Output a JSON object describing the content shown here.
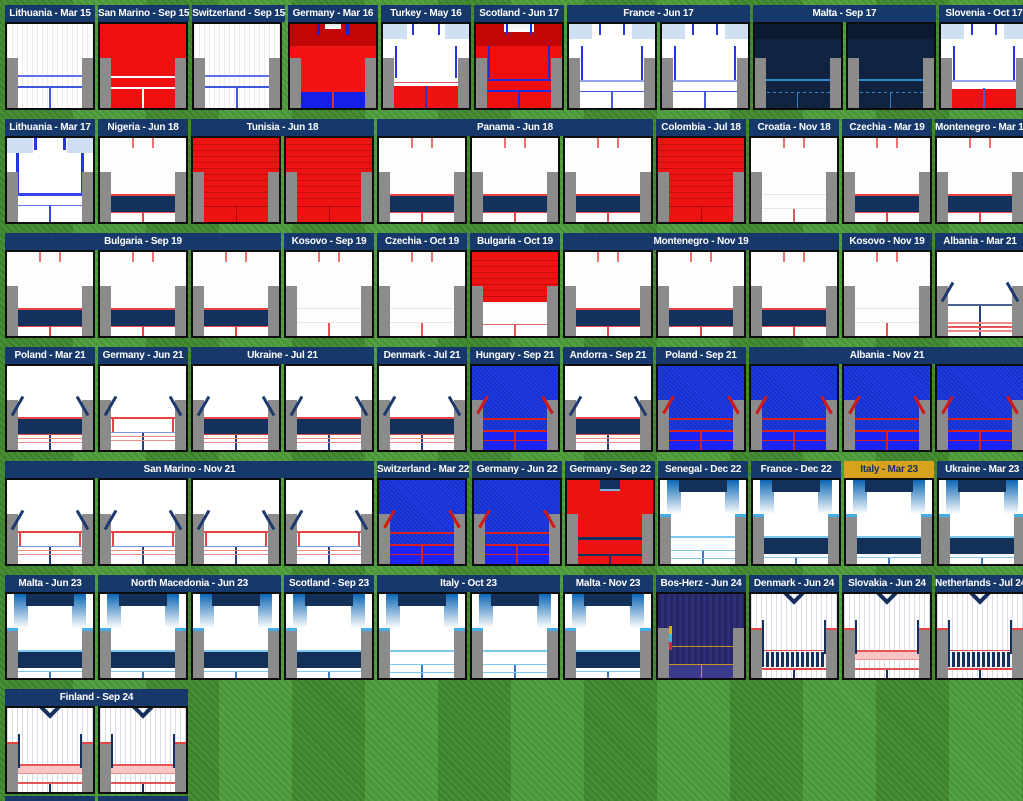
{
  "palette": {
    "header_navy": "#17386a",
    "header_gold": "#d7a31d",
    "grass_dark": "#41892f",
    "grass_light": "#4f9e3d",
    "jersey_border": "#0d0d0d",
    "sleeve_gray": "#8b8b8b"
  },
  "rows": [
    {
      "cells": [
        {
          "label": "Lithuania - Mar 15",
          "kit": "pinstripe15",
          "count": 1
        },
        {
          "label": "San Marino - Sep 15",
          "kit": "red15",
          "count": 1
        },
        {
          "label": "Switzerland - Sep 15",
          "kit": "pinstripe15",
          "count": 1
        },
        {
          "label": "Germany - Mar 16",
          "kit": "germany16",
          "count": 1
        },
        {
          "label": "Turkey - May 16",
          "kit": "turkey16",
          "count": 1
        },
        {
          "label": "Scotland - Jun 17",
          "kit": "scotland17",
          "count": 1
        },
        {
          "label": "France - Jun 17",
          "kit": "white17",
          "count": 2
        },
        {
          "label": "Malta - Sep 17",
          "kit": "navy17",
          "count": 2
        },
        {
          "label": "Slovenia - Oct 17",
          "kit": "slovenia17",
          "count": 1
        }
      ]
    },
    {
      "cells": [
        {
          "label": "Lithuania - Mar 17",
          "kit": "lithuania17",
          "count": 1
        },
        {
          "label": "Nigeria - Jun 18",
          "kit": "navyband18",
          "count": 1
        },
        {
          "label": "Tunisia - Jun 18",
          "kit": "redtex18",
          "count": 2
        },
        {
          "label": "Panama - Jun 18",
          "kit": "navyband18",
          "count": 3
        },
        {
          "label": "Colombia - Jul 18",
          "kit": "redtex18",
          "count": 1
        },
        {
          "label": "Croatia - Nov 18",
          "kit": "whiteplain",
          "count": 1
        },
        {
          "label": "Czechia - Mar 19",
          "kit": "navyband18",
          "count": 1
        },
        {
          "label": "Montenegro - Mar 19",
          "kit": "navyband18",
          "count": 1
        }
      ]
    },
    {
      "cells": [
        {
          "label": "Bulgaria - Sep 19",
          "kit": "navyband18",
          "count": 3
        },
        {
          "label": "Kosovo - Sep 19",
          "kit": "whiteplain",
          "count": 1
        },
        {
          "label": "Czechia - Oct 19",
          "kit": "whiteplain",
          "count": 1
        },
        {
          "label": "Bulgaria - Oct 19",
          "kit": "bulgaria19",
          "count": 1
        },
        {
          "label": "Montenegro - Nov 19",
          "kit": "navyband18",
          "count": 3
        },
        {
          "label": "Kosovo - Nov 19",
          "kit": "whiteplain",
          "count": 1
        },
        {
          "label": "Albania - Mar 21",
          "kit": "albania21",
          "count": 1
        }
      ]
    },
    {
      "cells": [
        {
          "label": "Poland - Mar 21",
          "kit": "diagband21",
          "count": 1
        },
        {
          "label": "Germany - Jun 21",
          "kit": "diagwhite21",
          "count": 1
        },
        {
          "label": "Ukraine - Jul 21",
          "kit": "diagband21",
          "count": 2
        },
        {
          "label": "Denmark - Jul 21",
          "kit": "diagband21",
          "count": 1
        },
        {
          "label": "Hungary - Sep 21",
          "kit": "blue21",
          "count": 1
        },
        {
          "label": "Andorra - Sep 21",
          "kit": "diagband21",
          "count": 1
        },
        {
          "label": "Poland - Sep 21",
          "kit": "blue21",
          "count": 1
        },
        {
          "label": "Albania - Nov 21",
          "kit": "blue21",
          "count": 3
        }
      ]
    },
    {
      "cells": [
        {
          "label": "San Marino - Nov 21",
          "kit": "diagwhite21",
          "count": 4
        },
        {
          "label": "Switzerland - Mar 22",
          "kit": "blue21",
          "count": 1
        },
        {
          "label": "Germany - Jun 22",
          "kit": "blue21",
          "count": 1
        },
        {
          "label": "Germany - Sep 22",
          "kit": "germany22",
          "count": 1
        },
        {
          "label": "Senegal - Dec 22",
          "kit": "gradient22",
          "count": 1
        },
        {
          "label": "France - Dec 22",
          "kit": "gradientband22",
          "count": 1
        },
        {
          "label": "Italy - Mar 23",
          "kit": "gradientband22",
          "count": 1,
          "header": "gold"
        },
        {
          "label": "Ukraine - Mar 23",
          "kit": "gradientband22",
          "count": 1
        }
      ]
    },
    {
      "cells": [
        {
          "label": "Malta - Jun 23",
          "kit": "gradientband22",
          "count": 1
        },
        {
          "label": "North Macedonia - Jun 23",
          "kit": "gradientband22",
          "count": 2
        },
        {
          "label": "Scotland - Sep 23",
          "kit": "gradientband22",
          "count": 1
        },
        {
          "label": "Italy - Oct 23",
          "kit": "gradient22",
          "count": 2
        },
        {
          "label": "Malta - Nov 23",
          "kit": "gradientband22",
          "count": 1
        },
        {
          "label": "Bos-Herz - Jun 24",
          "kit": "bosherz24",
          "count": 1
        },
        {
          "label": "Denmark - Jun 24",
          "kit": "pinstripe24navy",
          "count": 1
        },
        {
          "label": "Slovakia - Jun 24",
          "kit": "pinstripe24red",
          "count": 1
        },
        {
          "label": "Netherlands - Jul 24",
          "kit": "pinstripe24navy",
          "count": 1
        }
      ]
    },
    {
      "cells": [
        {
          "label": "Finland - Sep 24",
          "kit": "pinstripe24red",
          "count": 2
        }
      ]
    }
  ],
  "chart_data": {
    "type": "table",
    "title": "Shirts worn by match (opponent - date)",
    "columns": [
      "Match",
      "Kit style",
      "Shirts shown",
      "Header colour"
    ],
    "rows": [
      [
        "Lithuania - Mar 15",
        "white pinstripe, blue trim",
        1,
        "navy"
      ],
      [
        "San Marino - Sep 15",
        "red, white trim",
        1,
        "navy"
      ],
      [
        "Switzerland - Sep 15",
        "white pinstripe, blue trim",
        1,
        "navy"
      ],
      [
        "Germany - Mar 16",
        "red with blue hem",
        1,
        "navy"
      ],
      [
        "Turkey - May 16",
        "white with red hem",
        1,
        "navy"
      ],
      [
        "Scotland - Jun 17",
        "red with blue trim",
        1,
        "navy"
      ],
      [
        "France - Jun 17",
        "white, blue trim",
        2,
        "navy"
      ],
      [
        "Malta - Sep 17",
        "dark navy",
        2,
        "navy"
      ],
      [
        "Slovenia - Oct 17",
        "white with red hem",
        1,
        "navy"
      ],
      [
        "Lithuania - Mar 17",
        "white, bold blue lines",
        1,
        "navy"
      ],
      [
        "Nigeria - Jun 18",
        "white, navy band, red trim",
        1,
        "navy"
      ],
      [
        "Tunisia - Jun 18",
        "red textured",
        2,
        "navy"
      ],
      [
        "Panama - Jun 18",
        "white, navy band, red trim",
        3,
        "navy"
      ],
      [
        "Colombia - Jul 18",
        "red textured",
        1,
        "navy"
      ],
      [
        "Croatia - Nov 18",
        "plain white, red collar ticks",
        1,
        "navy"
      ],
      [
        "Czechia - Mar 19",
        "white, navy band, red trim",
        1,
        "navy"
      ],
      [
        "Montenegro - Mar 19",
        "white, navy band, red trim",
        1,
        "navy"
      ],
      [
        "Bulgaria - Sep 19",
        "white, navy band, red trim",
        3,
        "navy"
      ],
      [
        "Kosovo - Sep 19",
        "plain white, red collar ticks",
        1,
        "navy"
      ],
      [
        "Czechia - Oct 19",
        "plain white, red collar ticks",
        1,
        "navy"
      ],
      [
        "Bulgaria - Oct 19",
        "red top / white bottom",
        1,
        "navy"
      ],
      [
        "Montenegro - Nov 19",
        "white, navy band, red trim",
        3,
        "navy"
      ],
      [
        "Kosovo - Nov 19",
        "plain white, red collar ticks",
        1,
        "navy"
      ],
      [
        "Albania - Mar 21",
        "white, navy shoulder diagonals, red stripes",
        1,
        "navy"
      ],
      [
        "Poland - Mar 21",
        "white, navy diagonals, navy band",
        1,
        "navy"
      ],
      [
        "Germany - Jun 21",
        "white, navy diagonals, white band",
        1,
        "navy"
      ],
      [
        "Ukraine - Jul 21",
        "white, navy diagonals, navy band",
        2,
        "navy"
      ],
      [
        "Denmark - Jul 21",
        "white, navy diagonals, navy band",
        1,
        "navy"
      ],
      [
        "Hungary - Sep 21",
        "royal blue textured, red diagonals",
        1,
        "navy"
      ],
      [
        "Andorra - Sep 21",
        "white, navy diagonals, navy band",
        1,
        "navy"
      ],
      [
        "Poland - Sep 21",
        "royal blue textured, red diagonals",
        1,
        "navy"
      ],
      [
        "Albania - Nov 21",
        "royal blue textured, red diagonals",
        3,
        "navy"
      ],
      [
        "San Marino - Nov 21",
        "white, navy diagonals, white band",
        4,
        "navy"
      ],
      [
        "Switzerland - Mar 22",
        "royal blue textured, red diagonals",
        1,
        "navy"
      ],
      [
        "Germany - Jun 22",
        "royal blue textured, red diagonals",
        1,
        "navy"
      ],
      [
        "Germany - Sep 22",
        "red, navy collar inset",
        1,
        "navy"
      ],
      [
        "Senegal - Dec 22",
        "white, blue gradient shoulders",
        1,
        "navy"
      ],
      [
        "France - Dec 22",
        "white, blue gradient shoulders, navy band",
        1,
        "navy"
      ],
      [
        "Italy - Mar 23",
        "white, blue gradient shoulders, navy band",
        1,
        "gold"
      ],
      [
        "Ukraine - Mar 23",
        "white, blue gradient shoulders, navy band",
        1,
        "navy"
      ],
      [
        "Malta - Jun 23",
        "white, blue gradient shoulders, navy band",
        1,
        "navy"
      ],
      [
        "North Macedonia - Jun 23",
        "white, blue gradient shoulders, navy band",
        2,
        "navy"
      ],
      [
        "Scotland - Sep 23",
        "white, blue gradient shoulders, navy band",
        1,
        "navy"
      ],
      [
        "Italy - Oct 23",
        "white, blue gradient shoulders",
        2,
        "navy"
      ],
      [
        "Malta - Nov 23",
        "white, blue gradient shoulders, navy band",
        1,
        "navy"
      ],
      [
        "Bos-Herz - Jun 24",
        "dark purple stripes, gold trim",
        1,
        "navy"
      ],
      [
        "Denmark - Jun 24",
        "white pinstripe, navy V-collar, navy hatched band",
        1,
        "navy"
      ],
      [
        "Slovakia - Jun 24",
        "white pinstripe, navy V-collar, red/pink stripes",
        1,
        "navy"
      ],
      [
        "Netherlands - Jul 24",
        "white pinstripe, navy V-collar, navy hatched band",
        1,
        "navy"
      ],
      [
        "Finland - Sep 24",
        "white pinstripe, navy V-collar, red/pink stripes",
        2,
        "navy"
      ]
    ]
  }
}
